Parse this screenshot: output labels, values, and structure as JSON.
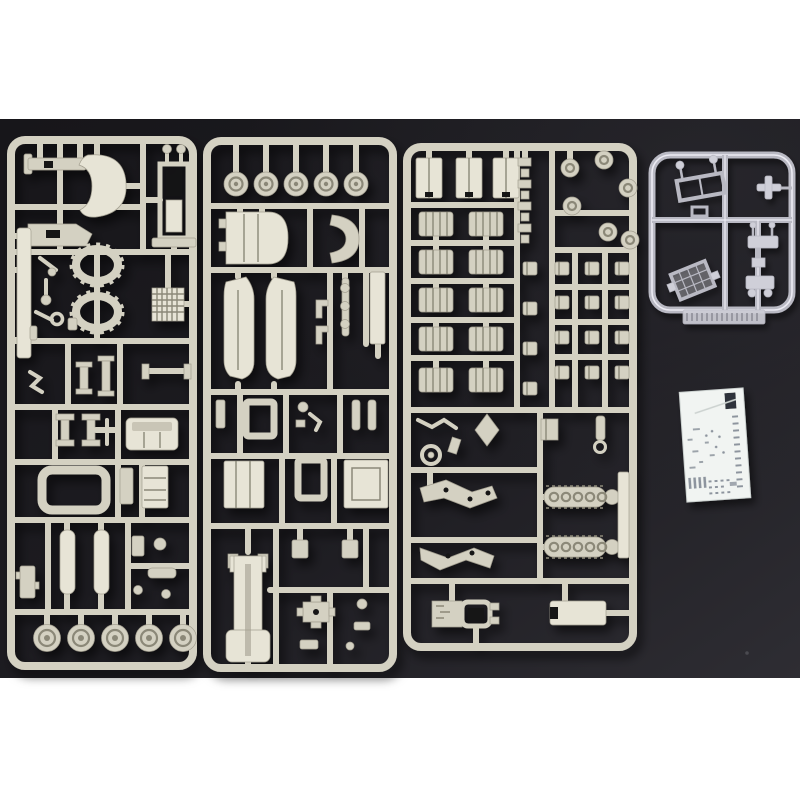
{
  "photo": {
    "kind": "photograph",
    "subject": "Plastic scale-model kit contents photographed on a dark mat",
    "letterbox": "white bands top and bottom"
  },
  "colors": {
    "paper_white": "#ffffff",
    "mat_dark": "#17161a",
    "mat_mid": "#1d1c21",
    "mat_light": "#2e2d33",
    "sprue": "#d4d1c2",
    "sprue_light": "#e7e4d6",
    "sprue_dark": "#a39f90",
    "sprue_shade": "#8b8878",
    "recess": "#141318",
    "clear_edge": "#b9b9c3",
    "clear_bright": "#ecebf3",
    "clear_fill": "#cfcfd8",
    "clear_rib": "#83838e",
    "decal_paper": "#f1f4f2",
    "decal_ink": "#8d949e",
    "decal_dark": "#2e333a",
    "decal_fold": "#ccd2d0",
    "dust": "#4a4a50"
  },
  "objects": {
    "sprue_left": {
      "label": "tan sprue A",
      "contents": "axle bars, yoke, seat tower, side plate, two castellated oval rings, radiator grille, small fittings, cab, open frame, twin cylinders, five road wheels"
    },
    "sprue_middle": {
      "label": "tan sprue B",
      "contents": "five wheel discs, engine hood, curved fender, two chassis side plates, storage boxes, ladder hull, small fittings"
    },
    "sprue_right": {
      "label": "tan sprue C",
      "contents": "three tank halves, link chain, six wheel discs, ten ribbed drums, fittings grid, two track runs, mount brackets, two chassis boxes"
    },
    "sprue_clear": {
      "label": "clear sprue",
      "contents": "windshield frame with mirrors, lamp cross, H-bracket, small carrier, glazed pane, embossed maker tab"
    },
    "decal_sheet": {
      "label": "white decal sheet with tiny blue-grey markings"
    }
  }
}
